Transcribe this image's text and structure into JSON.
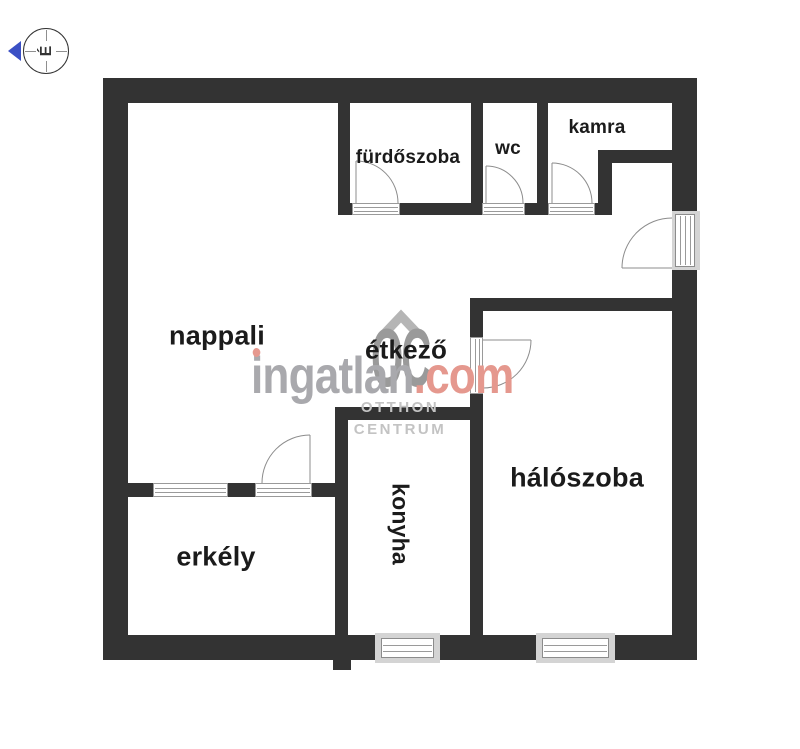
{
  "compass": {
    "north_letter": "É"
  },
  "rooms": {
    "nappali": {
      "label": "nappali"
    },
    "furdoszoba": {
      "label": "fürdőszoba"
    },
    "wc": {
      "label": "wc"
    },
    "kamra": {
      "label": "kamra"
    },
    "etkezo": {
      "label": "étkező"
    },
    "haloszoba": {
      "label": "hálószoba"
    },
    "konyha": {
      "label": "konyha"
    },
    "erkely": {
      "label": "erkély"
    }
  },
  "watermark": {
    "brand": "ingatlan",
    "tld": ".com",
    "monogram": "OC",
    "org_line1": "OTTHON",
    "org_line2": "CENTRUM"
  },
  "colors": {
    "wall": "#333333",
    "wm-gray": "#a9a9ad",
    "wm-red": "#e5988e",
    "logo-gray": "#9a9a9a",
    "org-gray": "#c3c3c3",
    "north-blue": "#3b50c5"
  }
}
